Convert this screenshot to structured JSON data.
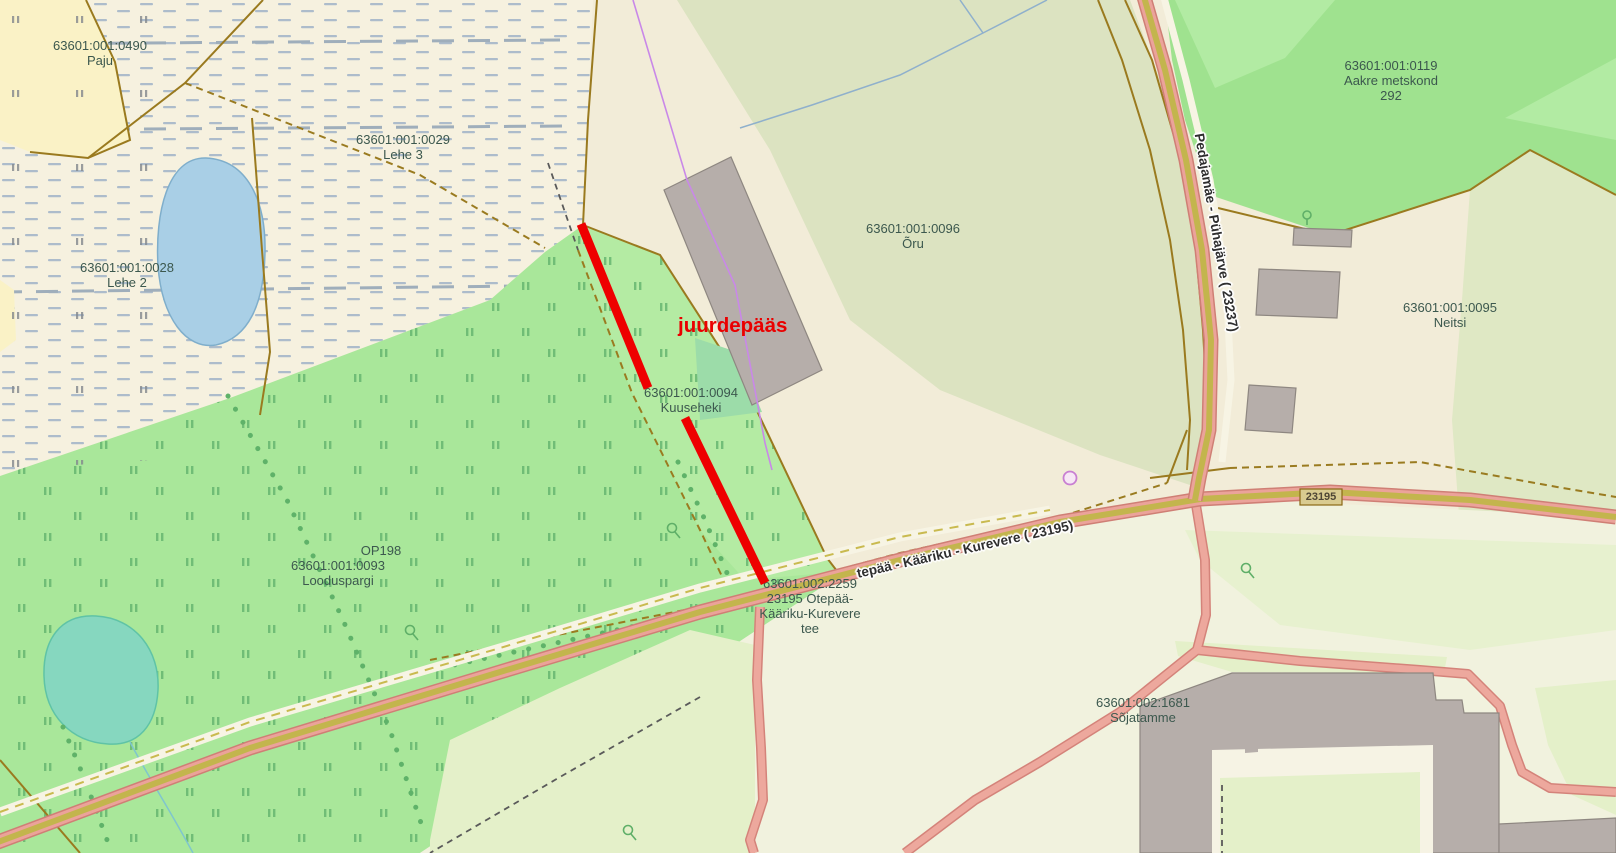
{
  "map_type": "cadastral-web-map",
  "annotation": {
    "text": "juurdepääs",
    "color": "#EA0000"
  },
  "shield": {
    "text": "23195"
  },
  "road_labels": [
    {
      "text": "tepää - Kääriku - Kurevere ( 23195)"
    },
    {
      "text": "Pedajamäe - Pühajärve ( 23237)"
    }
  ],
  "parcel_labels": [
    {
      "name": "parcel-label-0490",
      "x": 100,
      "y": 38,
      "lines": [
        "63601:001:0490",
        "Paju"
      ]
    },
    {
      "name": "parcel-label-0029",
      "x": 403,
      "y": 132,
      "lines": [
        "63601:001:0029",
        "Lehe 3"
      ]
    },
    {
      "name": "parcel-label-0028",
      "x": 127,
      "y": 260,
      "lines": [
        "63601:001:0028",
        "Lehe 2"
      ]
    },
    {
      "name": "parcel-label-0096",
      "x": 913,
      "y": 221,
      "lines": [
        "63601:001:0096",
        "Õru"
      ]
    },
    {
      "name": "parcel-label-0119",
      "x": 1391,
      "y": 58,
      "lines": [
        "63601:001:0119",
        "Aakre metskond",
        "292"
      ]
    },
    {
      "name": "parcel-label-0095",
      "x": 1450,
      "y": 300,
      "lines": [
        "63601:001:0095",
        "Neitsi"
      ]
    },
    {
      "name": "parcel-label-0094",
      "x": 691,
      "y": 385,
      "lines": [
        "63601:001:0094",
        "Kuuseheki"
      ]
    },
    {
      "name": "parcel-label-op198",
      "x": 381,
      "y": 543,
      "lines": [
        "OP198"
      ]
    },
    {
      "name": "parcel-label-0093",
      "x": 338,
      "y": 558,
      "lines": [
        "63601:001:0093",
        "Looduspargi"
      ]
    },
    {
      "name": "parcel-label-2259",
      "x": 810,
      "y": 576,
      "lines": [
        "63601:002:2259",
        "23195 Otepää-",
        "Kääriku-Kurevere",
        "tee"
      ]
    },
    {
      "name": "parcel-label-1681",
      "x": 1143,
      "y": 695,
      "lines": [
        "63601:002:1681",
        "Sõjatamme"
      ]
    }
  ],
  "palette": {
    "red_annotation": "#EE0000",
    "parcel_label_text": "#3C584E",
    "road_fill_pink": "#EBA39A",
    "road_casing": "#CF7F75",
    "road_center_olive": "#C3B54D",
    "minor_road": "#EDA89D",
    "forest_bright_green": "#A9E79A",
    "forest_dark_green": "#9FE28F",
    "field_sage": "#DCE3C1",
    "marsh_cream": "#F6F1DF",
    "base_beige": "#F2ECD8",
    "lake_blue": "#A9CFE6",
    "lake_teal": "#86D7BF",
    "building_gray": "#B6AEAA",
    "boundary_brown": "#9A7A1F",
    "powerline_purple": "#C988E8"
  }
}
